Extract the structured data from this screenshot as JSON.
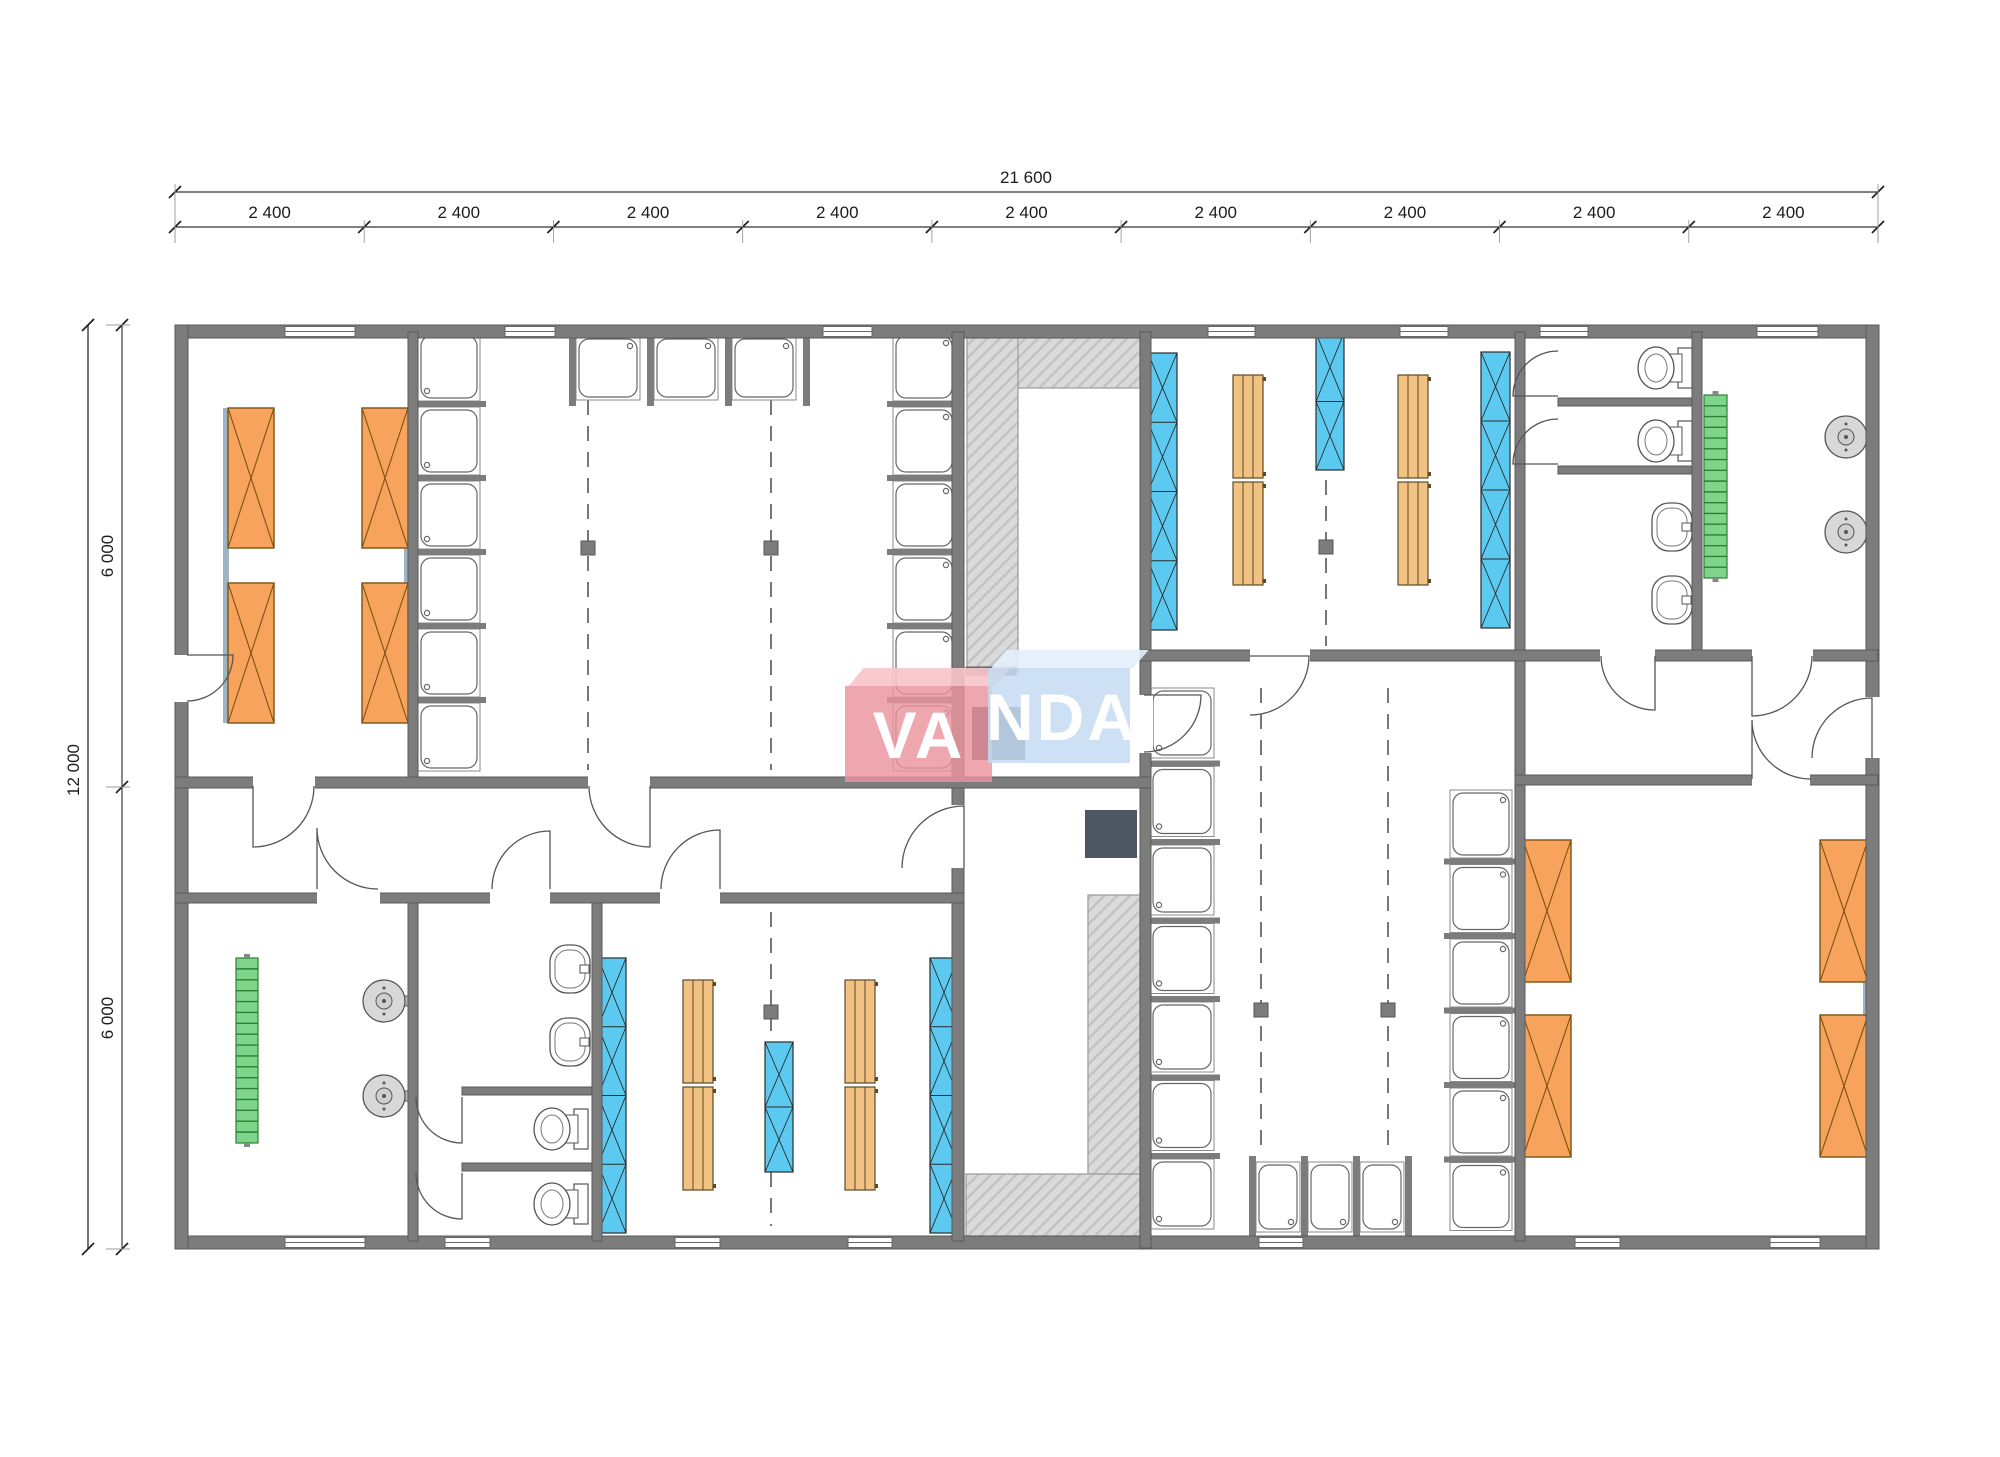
{
  "watermark": {
    "left_text": "VA",
    "right_text": "NDA",
    "pink": "rgba(236,148,158,0.82)",
    "pink_top": "rgba(247,196,201,0.9)",
    "blue": "rgba(197,219,241,0.85)",
    "blue_top": "rgba(227,239,251,0.9)"
  },
  "dimensions": {
    "top_total": "21 600",
    "top_segments": [
      "2 400",
      "2 400",
      "2 400",
      "2 400",
      "2 400",
      "2 400",
      "2 400",
      "2 400",
      "2 400"
    ],
    "left_total": "12 000",
    "left_segments": [
      "6 000",
      "6 000"
    ]
  },
  "plan": {
    "colors": {
      "wall": "#7c7c7c",
      "wall_edge": "#5a5a5a",
      "bed": "#F7A35C",
      "bed_line": "#7c5113",
      "locker": "#5BC9F0",
      "locker_line": "#2b2b2b",
      "bench": "#F2C283",
      "bench_line": "#5a4a28",
      "ladder": "#7FD48C",
      "ladder_line": "#2e7d32",
      "hatch": "#dadada",
      "hatch_line": "#c3c3c3",
      "pad": "#4d5663",
      "fix": "#5c5c5c",
      "strip": "#9db3c6",
      "dim": "#555555",
      "tick": "#222222"
    },
    "walls": [
      [
        175,
        325,
        1704,
        13
      ],
      [
        175,
        1236,
        1704,
        13
      ],
      [
        175,
        325,
        13,
        924
      ],
      [
        1866,
        325,
        13,
        924
      ],
      [
        408,
        332,
        10,
        450
      ],
      [
        952,
        332,
        12,
        455
      ],
      [
        1140,
        332,
        11,
        916
      ],
      [
        1515,
        332,
        10,
        909
      ],
      [
        1692,
        332,
        10,
        323
      ],
      [
        408,
        898,
        10,
        343
      ],
      [
        592,
        898,
        10,
        343
      ],
      [
        952,
        782,
        12,
        459
      ],
      [
        175,
        777,
        976,
        11
      ],
      [
        175,
        893,
        789,
        10
      ],
      [
        1140,
        650,
        738,
        11
      ],
      [
        1515,
        775,
        363,
        10
      ],
      [
        966,
        667,
        50,
        8
      ],
      [
        1558,
        398,
        134,
        8
      ],
      [
        1558,
        466,
        134,
        8
      ],
      [
        462,
        1087,
        130,
        8
      ],
      [
        462,
        1163,
        130,
        8
      ]
    ],
    "door_gaps": [
      [
        173,
        655,
        17,
        47
      ],
      [
        1864,
        697,
        17,
        61
      ],
      [
        1138,
        695,
        15,
        58
      ],
      [
        950,
        805,
        16,
        63
      ],
      [
        253,
        775,
        62,
        15
      ],
      [
        588,
        775,
        62,
        15
      ],
      [
        317,
        891,
        63,
        14
      ],
      [
        490,
        891,
        60,
        14
      ],
      [
        660,
        891,
        60,
        14
      ],
      [
        1250,
        648,
        60,
        15
      ],
      [
        1600,
        648,
        55,
        15
      ],
      [
        1752,
        648,
        61,
        15
      ],
      [
        1752,
        773,
        58,
        14
      ]
    ],
    "windows_top": [
      [
        285,
        70
      ],
      [
        505,
        50
      ],
      [
        823,
        49
      ],
      [
        1208,
        47
      ],
      [
        1400,
        48
      ],
      [
        1540,
        48
      ],
      [
        1757,
        61
      ]
    ],
    "windows_bottom": [
      [
        285,
        80
      ],
      [
        445,
        45
      ],
      [
        675,
        45
      ],
      [
        848,
        44
      ],
      [
        1259,
        44
      ],
      [
        1575,
        45
      ],
      [
        1770,
        50
      ]
    ],
    "doors": [
      [
        187,
        655,
        46,
        0,
        90
      ],
      [
        1872,
        758,
        60,
        270,
        180
      ],
      [
        1144,
        695,
        57,
        0,
        90
      ],
      [
        964,
        868,
        62,
        270,
        180
      ],
      [
        253,
        786,
        61,
        90,
        0
      ],
      [
        650,
        786,
        61,
        90,
        180
      ],
      [
        317,
        889,
        61,
        270,
        0
      ],
      [
        550,
        889,
        58,
        270,
        180
      ],
      [
        720,
        889,
        59,
        270,
        180
      ],
      [
        1250,
        656,
        59,
        0,
        90
      ],
      [
        1655,
        656,
        54,
        90,
        180
      ],
      [
        1752,
        656,
        60,
        90,
        0
      ],
      [
        1752,
        779,
        59,
        270,
        0
      ],
      [
        1558,
        396,
        45,
        180,
        270
      ],
      [
        1558,
        464,
        45,
        180,
        270
      ],
      [
        462,
        1097,
        46,
        90,
        180
      ],
      [
        462,
        1173,
        46,
        90,
        180
      ]
    ],
    "beds": [
      [
        228,
        408,
        46,
        140
      ],
      [
        362,
        408,
        46,
        140
      ],
      [
        228,
        583,
        46,
        140
      ],
      [
        362,
        583,
        46,
        140
      ],
      [
        1523,
        840,
        48,
        142
      ],
      [
        1820,
        840,
        48,
        142
      ],
      [
        1523,
        1015,
        48,
        142
      ],
      [
        1820,
        1015,
        48,
        142
      ]
    ],
    "bed_strips": [
      [
        223,
        408,
        6,
        315
      ],
      [
        404,
        408,
        6,
        315
      ],
      [
        1518,
        840,
        5,
        317
      ],
      [
        1863,
        840,
        5,
        317
      ]
    ],
    "lockers": [
      [
        1148,
        353,
        29,
        277,
        4
      ],
      [
        1316,
        333,
        28,
        137,
        2
      ],
      [
        1481,
        352,
        29,
        276,
        4
      ],
      [
        598,
        958,
        28,
        275,
        4
      ],
      [
        765,
        1042,
        28,
        130,
        2
      ],
      [
        930,
        958,
        28,
        275,
        4
      ]
    ],
    "benches": [
      [
        1233,
        375,
        30,
        103
      ],
      [
        1233,
        482,
        30,
        103
      ],
      [
        1398,
        375,
        30,
        103
      ],
      [
        1398,
        482,
        30,
        103
      ],
      [
        683,
        980,
        30,
        103
      ],
      [
        683,
        1087,
        30,
        103
      ],
      [
        845,
        980,
        30,
        103
      ],
      [
        845,
        1087,
        30,
        103
      ]
    ],
    "showers": [
      {
        "x": 418,
        "y": 333,
        "w": 62,
        "h": 68,
        "count": 6,
        "dir": "E",
        "pitch": 74
      },
      {
        "x": 893,
        "y": 333,
        "w": 62,
        "h": 68,
        "count": 6,
        "dir": "W",
        "pitch": 74
      },
      {
        "x": 576,
        "y": 336,
        "w": 64,
        "h": 64,
        "count": 3,
        "dir": "S",
        "pitch": 78
      },
      {
        "x": 1150,
        "y": 688,
        "w": 64,
        "h": 70,
        "count": 7,
        "dir": "E",
        "pitch": 78.5
      },
      {
        "x": 1450,
        "y": 790,
        "w": 62,
        "h": 68,
        "count": 6,
        "dir": "W",
        "pitch": 74.5
      },
      {
        "x": 1256,
        "y": 1162,
        "w": 44,
        "h": 70,
        "count": 3,
        "dir": "N",
        "pitch": 52
      }
    ],
    "toilets": [
      [
        1638,
        346
      ],
      [
        1638,
        419
      ],
      [
        534,
        1107
      ],
      [
        534,
        1182
      ]
    ],
    "sinks": [
      [
        1652,
        503
      ],
      [
        1652,
        576
      ],
      [
        550,
        945
      ],
      [
        550,
        1018
      ]
    ],
    "heaters": [
      [
        1846,
        437
      ],
      [
        1846,
        532
      ],
      [
        384,
        1001
      ],
      [
        384,
        1096
      ]
    ],
    "ladders": [
      [
        1704,
        395,
        23,
        183
      ],
      [
        236,
        958,
        22,
        185
      ]
    ],
    "hatches": [
      [
        967,
        332,
        173,
        56
      ],
      [
        967,
        332,
        51,
        340
      ],
      [
        1088,
        895,
        52,
        341
      ],
      [
        966,
        1174,
        174,
        62
      ]
    ],
    "pads": [
      [
        972,
        707,
        53,
        53
      ],
      [
        1085,
        810,
        52,
        48
      ]
    ],
    "columns": [
      [
        588,
        548
      ],
      [
        771,
        548
      ],
      [
        1326,
        547
      ],
      [
        771,
        1012
      ],
      [
        1261,
        1010
      ],
      [
        1388,
        1010
      ]
    ],
    "dashes": [
      [
        588,
        400,
        770
      ],
      [
        771,
        400,
        770
      ],
      [
        1326,
        480,
        646
      ],
      [
        771,
        912,
        1226
      ],
      [
        1261,
        688,
        1152
      ],
      [
        1388,
        688,
        1152
      ]
    ],
    "frame": {
      "x0": 175,
      "x1": 1878,
      "y0": 325,
      "y1": 1249,
      "top_total_y": 192,
      "top_seg_y": 227,
      "left_total_x": 88,
      "left_seg_x": 122
    }
  }
}
